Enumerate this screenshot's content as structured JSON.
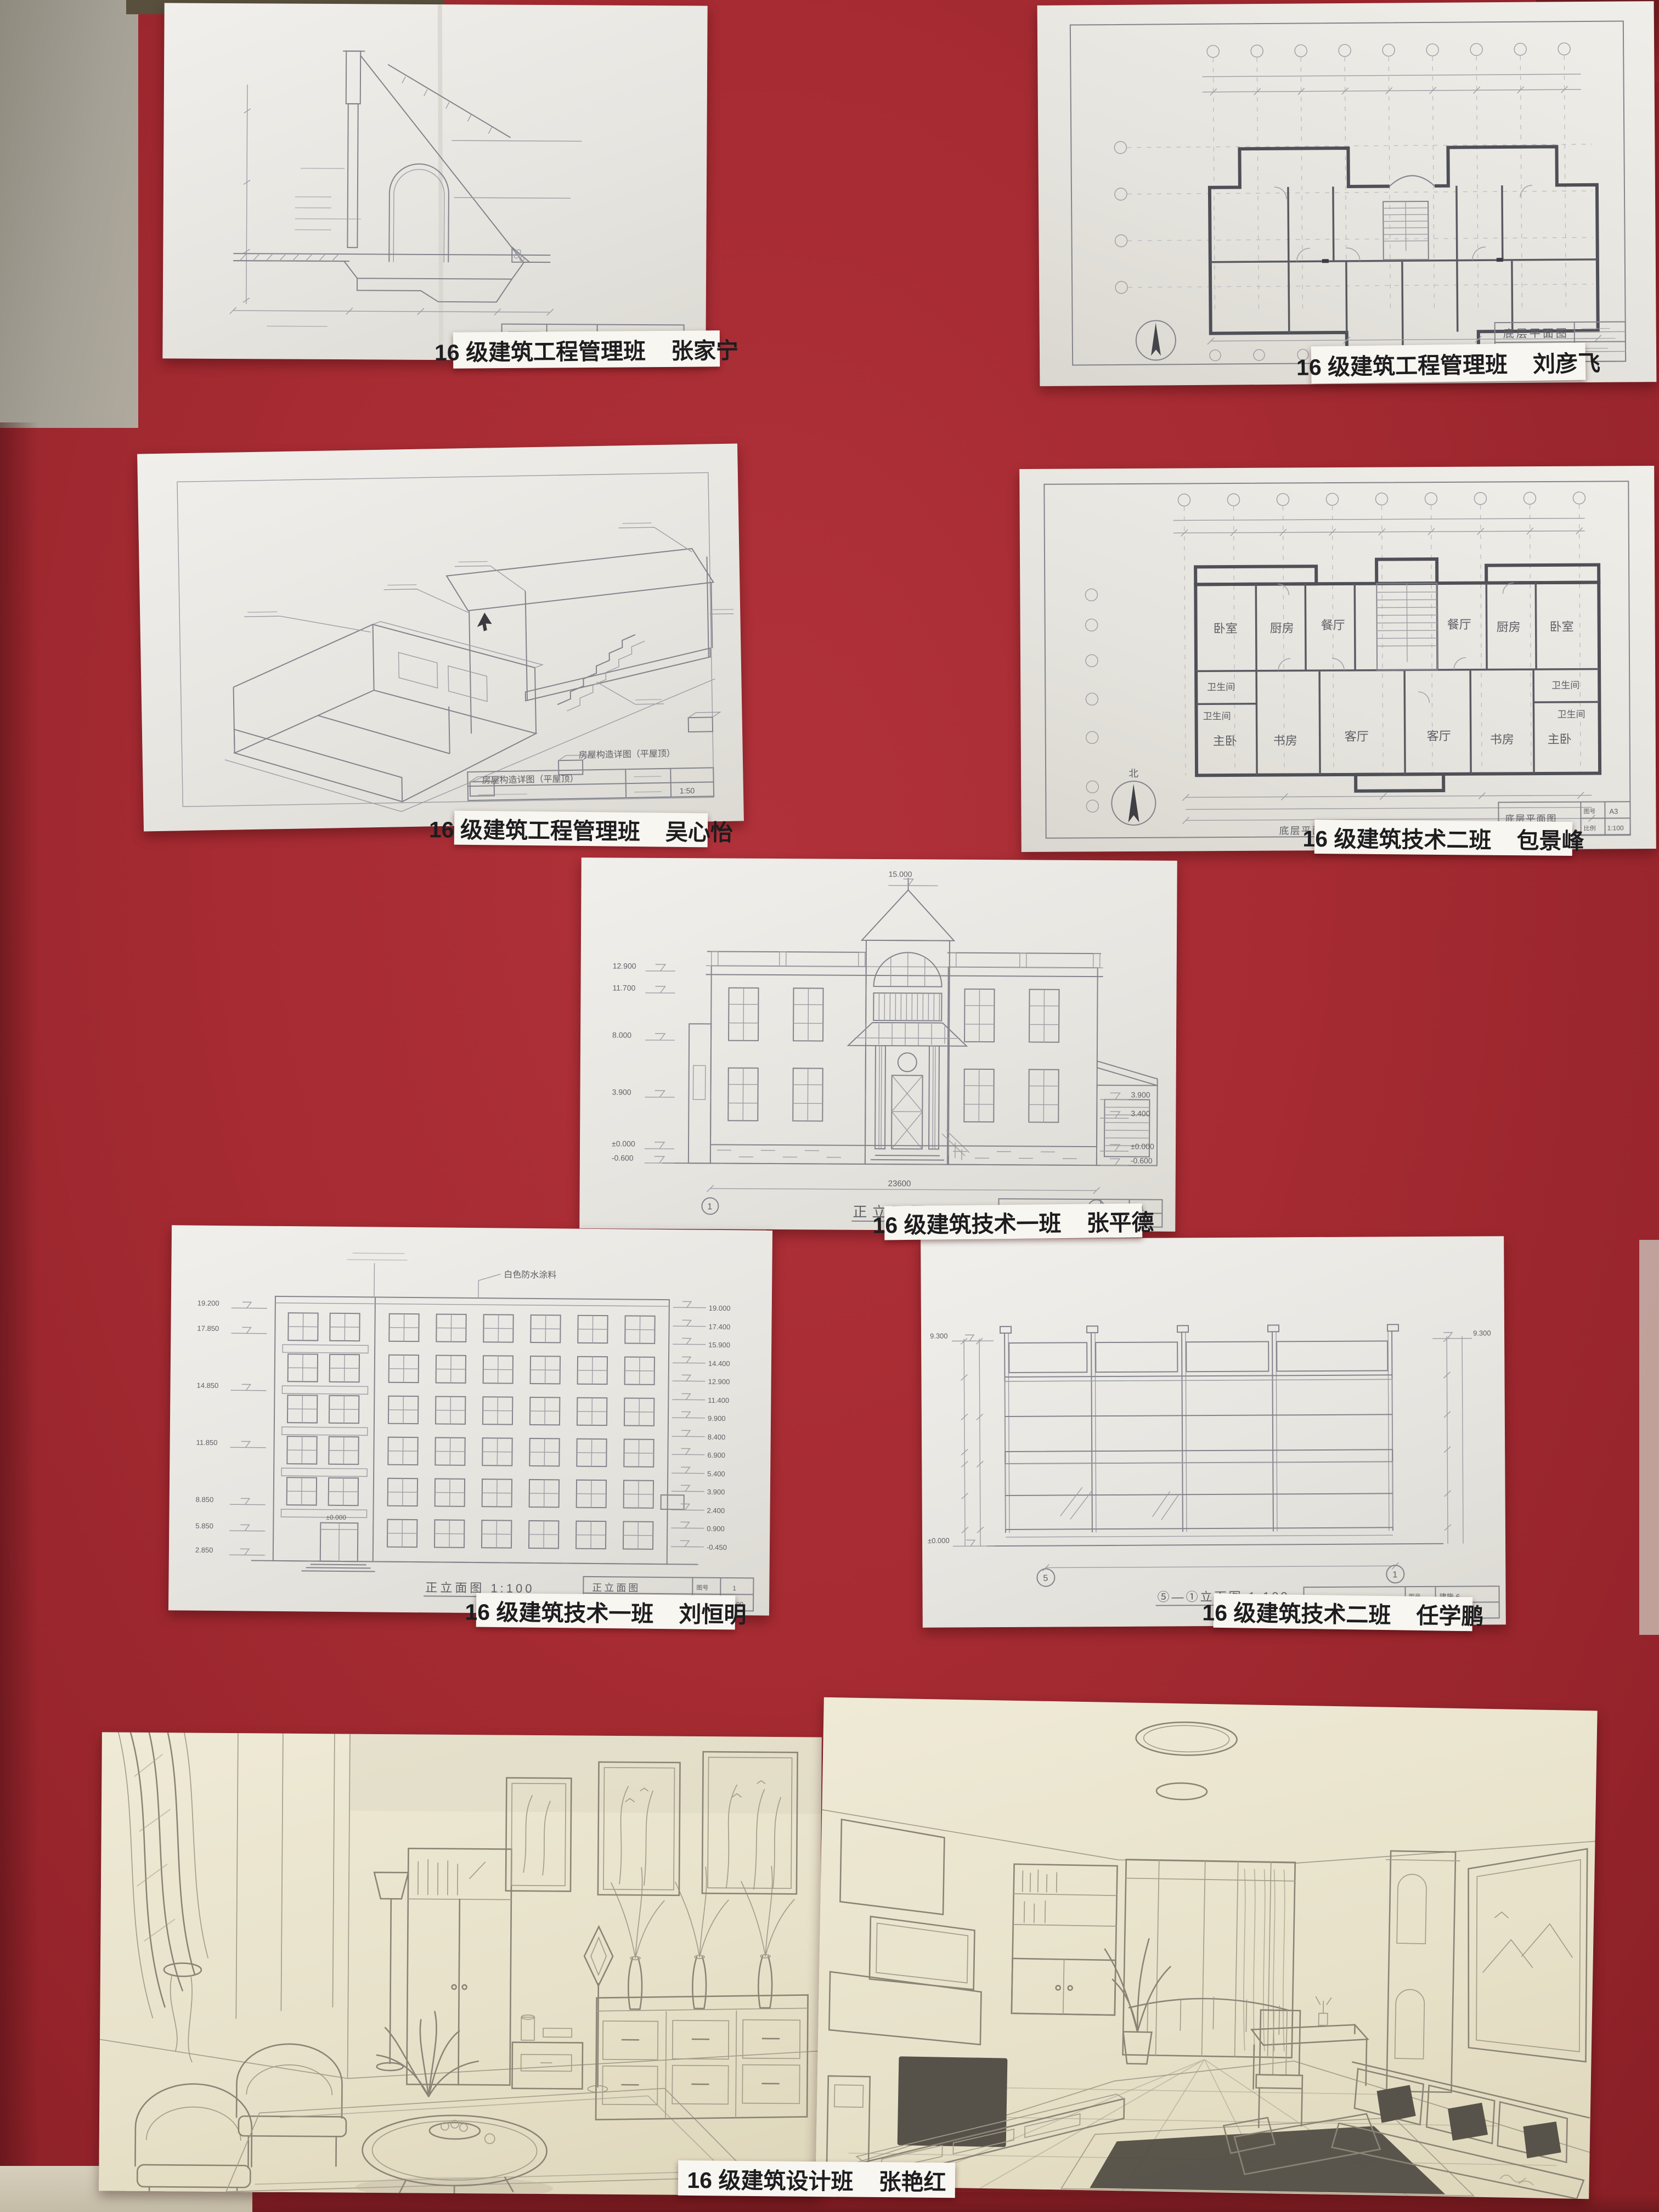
{
  "board": {
    "bg_color": "#a62b32",
    "labels": [
      {
        "class_name": "16 级建筑工程管理班",
        "student": "张家宁"
      },
      {
        "class_name": "16 级建筑工程管理班",
        "student": "刘彦飞"
      },
      {
        "class_name": "16 级建筑工程管理班",
        "student": "吴心怡"
      },
      {
        "class_name": "16 级建筑技术二班",
        "student": "包景峰"
      },
      {
        "class_name": "16 级建筑技术一班",
        "student": "张平德"
      },
      {
        "class_name": "16 级建筑技术一班",
        "student": "刘恒明"
      },
      {
        "class_name": "16 级建筑技术二班",
        "student": "任学鹏"
      },
      {
        "class_name": "16 级建筑设计班",
        "student": "张艳红"
      }
    ]
  },
  "drawings": {
    "plan_top": {
      "title": "底层平面图"
    },
    "axono": {
      "title": "房屋构造详图（平屋顶）",
      "scale": "1:50"
    },
    "plan_mid": {
      "caption": "底层平面图 1:100",
      "title": "底层平面图",
      "sheet_no_label": "图号",
      "sheet_no": "A3",
      "scale_label": "比例",
      "scale": "1:100",
      "north": "北",
      "total_dim": "23640",
      "rooms": [
        "卧室",
        "厨房",
        "餐厅",
        "餐厅",
        "厨房",
        "卧室",
        "卫生间",
        "卫生间",
        "卫生间",
        "卫生间",
        "主卧",
        "书房",
        "客厅",
        "客厅",
        "书房",
        "主卧"
      ]
    },
    "villa": {
      "caption": "正立面图",
      "caption_scale": "1:100",
      "title": "正立面图",
      "top_level": "15.000",
      "levels_left": [
        "12.900",
        "11.700",
        "8.000",
        "3.900",
        "±0.000",
        "-0.600"
      ],
      "levels_right": [
        "3.900",
        "3.400",
        "±0.000",
        "-0.600"
      ],
      "total_dim": "23600",
      "axis_first": "1",
      "axis_last": "7",
      "sheet_no_label": "图号",
      "sheet_no": "1",
      "scale_label": "比例",
      "scale": "1:100"
    },
    "sixstory": {
      "caption": "正立面图 1:100",
      "title": "正立面图",
      "note_top": "白色防水涂料",
      "zero_level": "±0.000",
      "levels_left": [
        "19.200",
        "17.850",
        "14.850",
        "11.850",
        "8.850",
        "5.850",
        "2.850"
      ],
      "levels_right": [
        "19.000",
        "17.400",
        "15.900",
        "14.400",
        "12.900",
        "11.400",
        "9.900",
        "8.400",
        "6.900",
        "5.400",
        "3.900",
        "2.400",
        "0.900",
        "-0.450"
      ],
      "sheet_no_label": "图号",
      "sheet_no": "1",
      "scale_label": "比例",
      "scale": "1:100"
    },
    "storefront": {
      "caption": "⑤—①立面图 1:100",
      "title": "⑤—①立面图",
      "axis_first": "5",
      "axis_last": "1",
      "level_top": "9.300",
      "level_zero": "±0.000",
      "sheet_no_label": "图号",
      "sheet_no": "建施-6",
      "scale_label": "比例",
      "scale": "1:100"
    }
  }
}
